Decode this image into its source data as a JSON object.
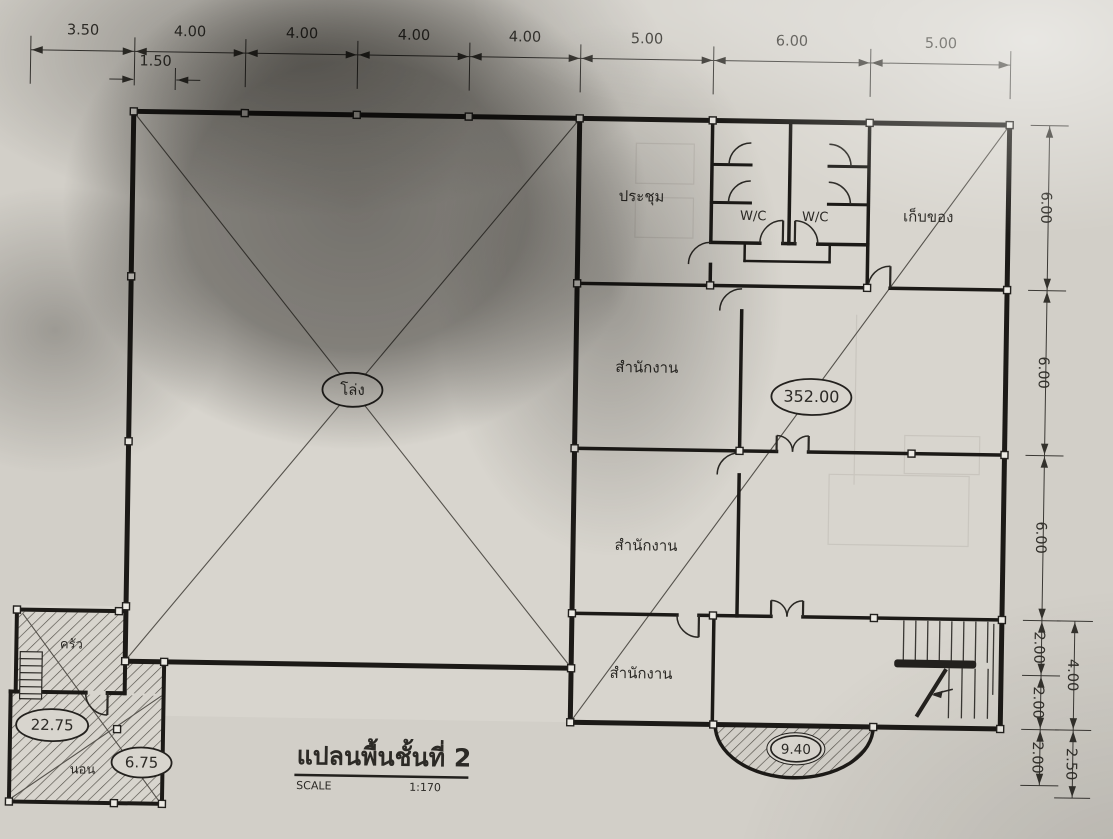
{
  "title_block": {
    "title": "แปลนพื้นชั้นที่ 2",
    "scale_label": "SCALE",
    "scale_value": "1:170"
  },
  "rooms": {
    "hall": "โล่ง",
    "meeting_room": "ประชุม",
    "wc_left": "W/C",
    "wc_right": "W/C",
    "storage": "เก็บของ",
    "office_top": "สำนักงาน",
    "office_middle": "สำนักงาน",
    "office_bottom": "สำนักงาน",
    "kitchen": "ครัว",
    "bedroom": "นอน"
  },
  "area_values": {
    "main_floor": "352.00",
    "balcony": "9.40",
    "annex": "22.75",
    "annex_small": "6.75"
  },
  "dimensions": {
    "top": [
      "3.50",
      "4.00",
      "4.00",
      "4.00",
      "4.00",
      "5.00",
      "6.00",
      "5.00"
    ],
    "top_sub": "1.50",
    "right_inner": [
      "6.00",
      "6.00",
      "6.00",
      "2.00",
      "2.00",
      "2.00"
    ],
    "right_outer": [
      "4.00",
      "2.50"
    ]
  },
  "colors": {
    "paper": "#d6d3cc",
    "ink": "#1c1a17",
    "shadow": "#282622"
  }
}
